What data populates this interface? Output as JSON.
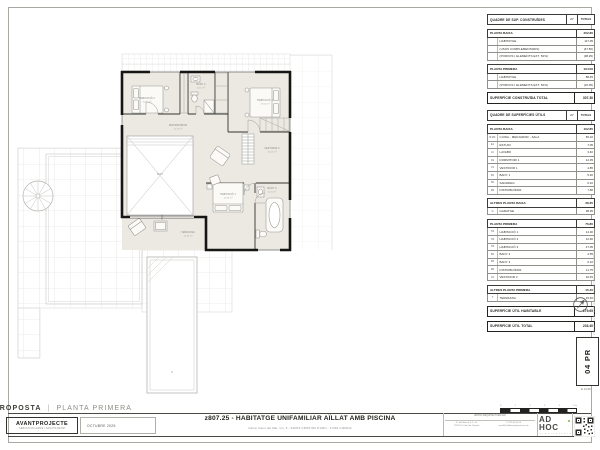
{
  "sheet": {
    "proposta_label": "PROPOSTA",
    "fase_label": "PLANTA PRIMERA",
    "separator": "|",
    "project_type": "AVANTPROJECTE",
    "authors": "SEBASTIAN LEMKE / SASCHA REHM",
    "date": "OCTUBRE 2025",
    "title": "z807.25 - HABITATGE UNIFAMILIAR AÏLLAT AMB PISCINA",
    "address": "Carrer Camí del Mar, s/n, 5  -  SANTA CRISTINA D'ARO  -  17246 GIRONA",
    "sheet_number": "04 PR",
    "scale_label": "E 1/100",
    "margin_note": "z807.25 · AVANTPROJECTE · PROPOSTA | PLANTA PRIMERA",
    "logo_text": "AD HOC",
    "logo_tagline": "a r q u i t e c t u r a",
    "contact_top": "ADHOC ARQUITECTURA SLP",
    "contact_col1": [
      "Pl. del Mercat 9, 1r 2a",
      "17220 St. Feliu de Guíxols"
    ],
    "contact_col2": [
      "T. 972 32 00 00",
      "estudi@adhocarquitectura.com"
    ]
  },
  "scalebar": {
    "labels": [
      "0",
      "1",
      "2",
      "3",
      "4",
      "5 m"
    ]
  },
  "tables": {
    "blocks": [
      {
        "type": "title",
        "label": "QUADRE DE SUP. CONSTRUÏDES",
        "col1": "m²",
        "col2": "TOTALS"
      },
      {
        "type": "section",
        "label": "PLANTA BAIXA",
        "total": "202.80",
        "rows": [
          [
            "",
            "HABITATGE",
            "117.05"
          ],
          [
            "",
            "(USOS COMPLEMENTARIS)",
            "(47.50)"
          ],
          [
            "",
            "(PORXOS I ELEMENTS EXT. 50%)",
            "(38.25)"
          ]
        ]
      },
      {
        "type": "section",
        "label": "PLANTA PRIMERA",
        "total": "104.50",
        "rows": [
          [
            "",
            "HABITATGE",
            "88.45"
          ],
          [
            "",
            "(PORXOS I ELEMENTS EXT. 50%)",
            "(16.05)"
          ]
        ]
      },
      {
        "type": "totalbar",
        "label": "SUPERFÍCIE CONSTRUÏDA TOTAL",
        "total": "307.30"
      },
      {
        "type": "title",
        "gap": true,
        "label": "QUADRE DE SUPERFÍCIES ÚTILS",
        "col1": "m²",
        "col2": "TOTALS"
      },
      {
        "type": "section",
        "label": "PLANTA BAIXA",
        "total": "102.85",
        "rows": [
          [
            "B.MC",
            "CUINA - MENJADOR - SALA",
            "56.10"
          ],
          [
            "E1",
            "ESTUDI",
            "7.05"
          ],
          [
            "LV",
            "LAVABO",
            "3.40"
          ],
          [
            "D1",
            "DORMITORI 1",
            "12.35"
          ],
          [
            "V1",
            "VESTIDOR 1",
            "4.85"
          ],
          [
            "B1",
            "BANY 1",
            "5.20"
          ],
          [
            "SF",
            "SAFAREIG",
            "6.10"
          ],
          [
            "DS",
            "DISTRIBUÏDOR",
            "7.80"
          ]
        ]
      },
      {
        "type": "section",
        "label": "ALTRES PLANTA BAIXA",
        "total": "38.35",
        "rows": [
          [
            "G",
            "GARATGE",
            "38.35"
          ]
        ]
      },
      {
        "type": "section",
        "label": "PLANTA PRIMERA",
        "total": "76.80",
        "rows": [
          [
            "H1",
            "HABITACIÓ 1",
            "14.30"
          ],
          [
            "H2",
            "HABITACIÓ 2",
            "12.60"
          ],
          [
            "H3",
            "HABITACIÓ 3",
            "17.05"
          ],
          [
            "B2",
            "BANY 2",
            "4.55"
          ],
          [
            "B3",
            "BANY 3",
            "6.10"
          ],
          [
            "DS",
            "DISTRIBUÏDOR",
            "11.75"
          ],
          [
            "V2",
            "VESTIDOR 2",
            "10.45"
          ]
        ]
      },
      {
        "type": "section",
        "label": "ALTRES PLANTA PRIMERA",
        "total": "15.40",
        "rows": [
          [
            "T",
            "TERRASSA",
            "15.40"
          ]
        ]
      },
      {
        "type": "totalbar",
        "label": "SUPERFÍCIE ÚTIL HABITABLE",
        "total": "179.65"
      },
      {
        "type": "totalbar",
        "label": "SUPERFÍCIE ÚTIL TOTAL",
        "total": "233.40"
      }
    ]
  },
  "plan": {
    "rooms": {
      "habitacio1": {
        "name": "HABITACIÓ 1",
        "area": "14.30 m²"
      },
      "habitacio2": {
        "name": "HABITACIÓ 2",
        "area": "12.60 m²"
      },
      "habitacio3": {
        "name": "HABITACIÓ 3",
        "area": "17.05 m²"
      },
      "distribuidor": {
        "name": "DISTRIBUÏDOR",
        "area": "11.75 m²"
      },
      "vestidor2": {
        "name": "VESTIDOR 2",
        "area": "10.45 m²"
      },
      "bany2": {
        "name": "BANY 2",
        "area": "4.55 m²"
      },
      "bany3": {
        "name": "BANY 3",
        "area": "6.10 m²"
      },
      "terrassa": {
        "name": "TERRASSA",
        "area": "15.40 m²"
      },
      "buit": {
        "name": "BUIT",
        "area": ""
      }
    }
  }
}
